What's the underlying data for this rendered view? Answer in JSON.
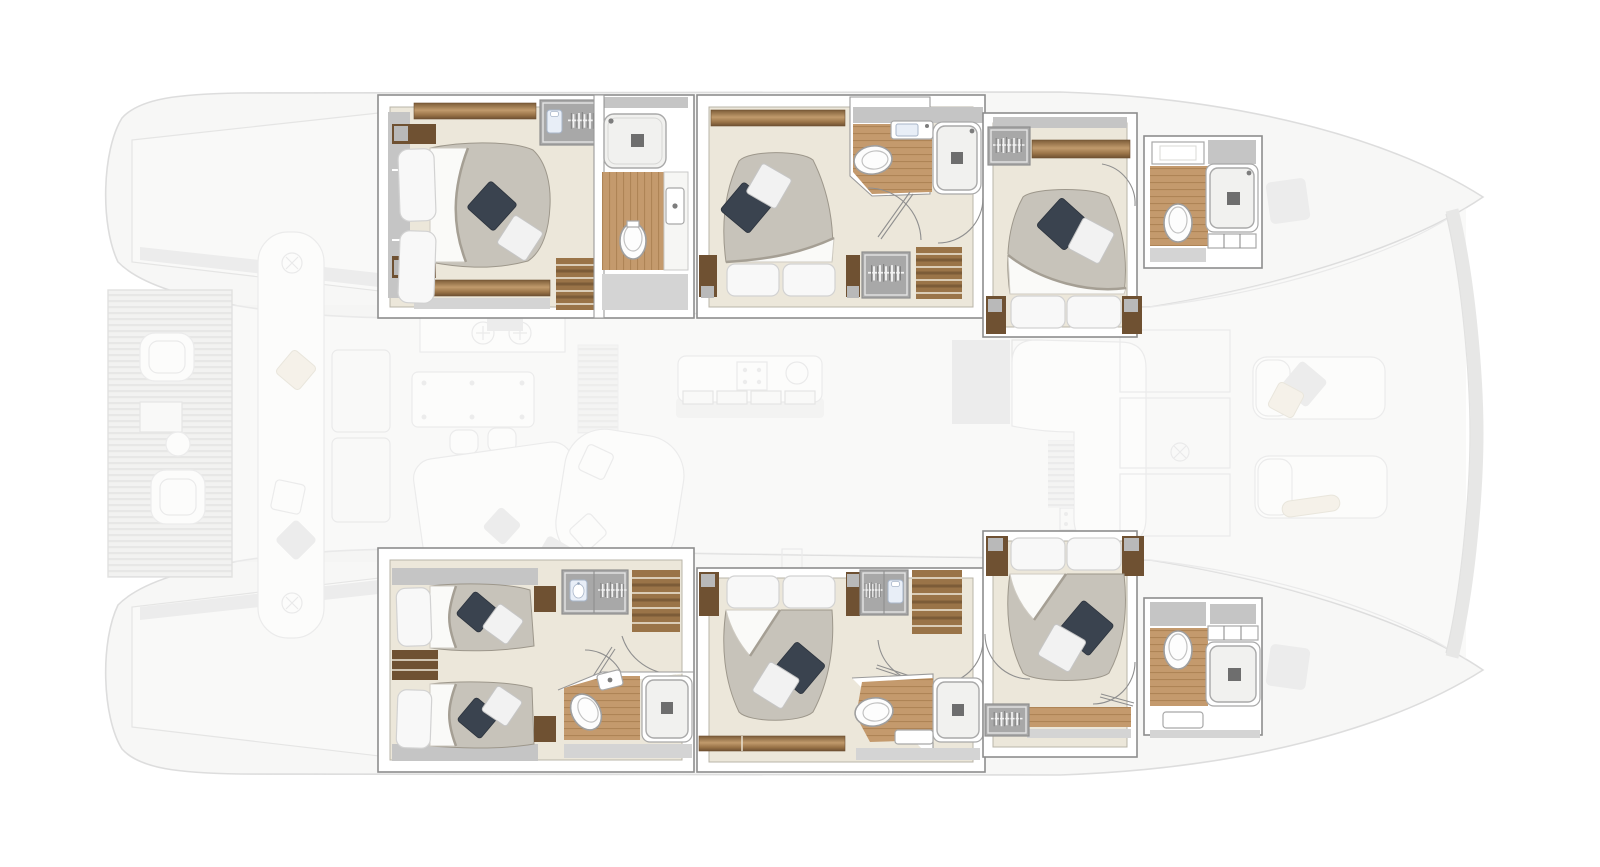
{
  "meta": {
    "type": "yacht-floorplan",
    "view": "top-down",
    "vessel": "sailing catamaran",
    "layout_name": "6-cabin guest version",
    "highlight": "six en-suite cabins shown in full color; decks, salon and foredeck shown faded"
  },
  "colors": {
    "floor": "#ece7da",
    "band": "#c5c5c5",
    "wood": "#c49a6d",
    "woodMid": "#9a7448",
    "woodDark": "#6f5132",
    "wardrobe": "#a8a8a8",
    "duvet": "#c7c3ba",
    "duvetShadow": "#a59f94",
    "pillow": "#f8f8f8",
    "navy": "#3a434f",
    "tray": "#f1f1ef",
    "drain": "#6e6e6e",
    "accentBlue": "#e8eef7",
    "fadedFill": "#f3f3f2",
    "fadedLine": "#c9c9c9"
  },
  "rooms": [
    {
      "id": "cabin-port-aft",
      "name": "Port aft double cabin",
      "features": [
        "double bed",
        "wardrobe",
        "en-suite shower",
        "toilet",
        "washbasin",
        "companionway stairs"
      ]
    },
    {
      "id": "cabin-port-mid",
      "name": "Port midship double cabin",
      "features": [
        "double bed",
        "wardrobe",
        "en-suite shower",
        "toilet",
        "washbasin",
        "companionway stairs"
      ]
    },
    {
      "id": "cabin-port-fwd",
      "name": "Port forward double cabin",
      "features": [
        "double bed",
        "wardrobe",
        "en-suite shower",
        "toilet",
        "washbasin"
      ]
    },
    {
      "id": "cabin-stbd-aft",
      "name": "Starboard aft twin cabin",
      "features": [
        "twin beds",
        "wardrobe",
        "washbasin cabinet",
        "en-suite shower",
        "toilet",
        "companionway stairs"
      ]
    },
    {
      "id": "cabin-stbd-mid",
      "name": "Starboard midship double cabin",
      "features": [
        "double bed",
        "wardrobe",
        "en-suite shower",
        "toilet",
        "companionway stairs"
      ]
    },
    {
      "id": "cabin-stbd-fwd",
      "name": "Starboard forward double cabin",
      "features": [
        "double bed",
        "wardrobe",
        "en-suite shower",
        "toilet",
        "washbasin"
      ]
    }
  ],
  "faded_areas": [
    {
      "id": "aft-platform",
      "name": "Aft teak platform with lounge chairs"
    },
    {
      "id": "aft-cockpit",
      "name": "Aft cockpit bench and consoles"
    },
    {
      "id": "salon",
      "name": "Main-deck salon, galley and dinette"
    },
    {
      "id": "foredeck",
      "name": "Foredeck with sun pads, mast base and crossbeam"
    }
  ]
}
